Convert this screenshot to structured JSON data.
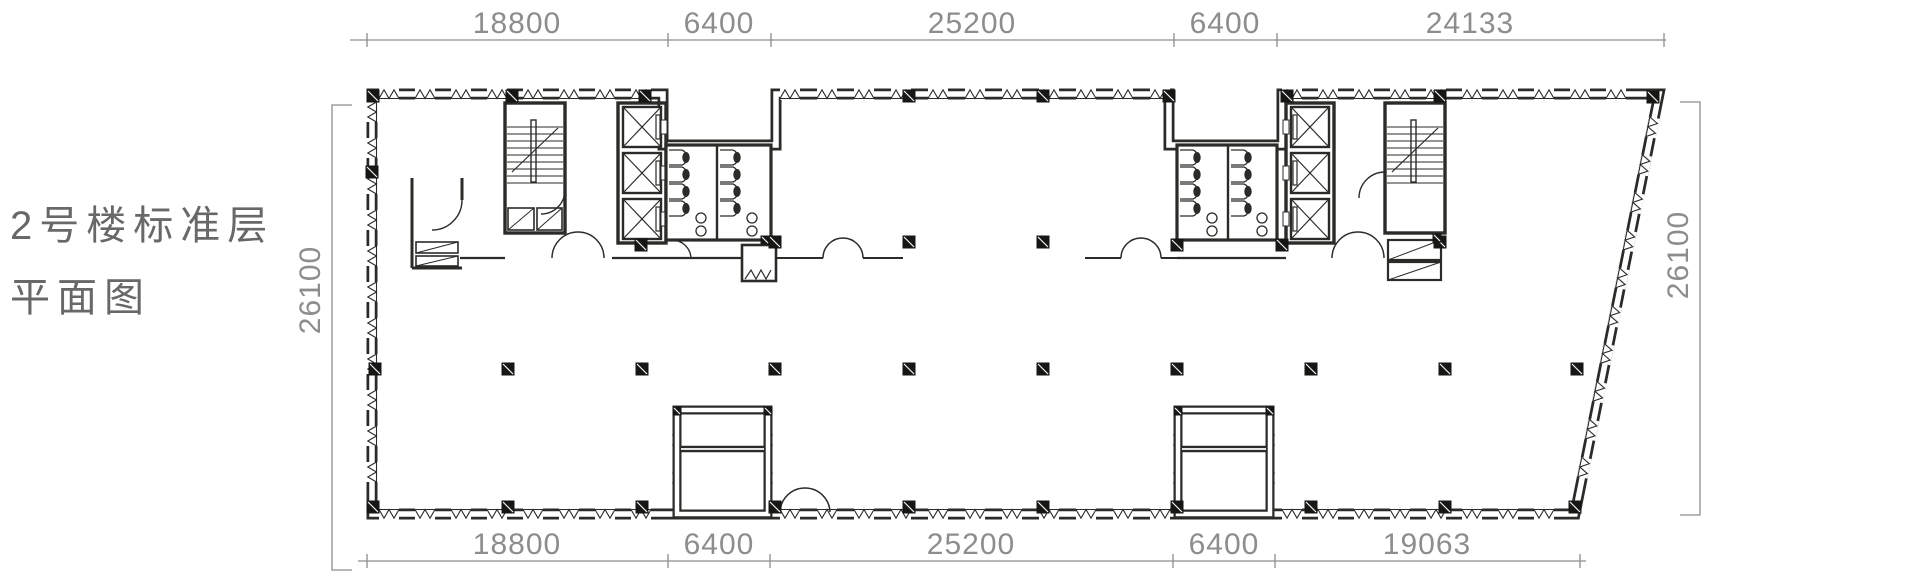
{
  "title": {
    "line1": "2号楼标准层",
    "line2": "平面图"
  },
  "dimensions": {
    "top": [
      {
        "label": "18800"
      },
      {
        "label": "6400"
      },
      {
        "label": "25200"
      },
      {
        "label": "6400"
      },
      {
        "label": "24133"
      }
    ],
    "bottom": [
      {
        "label": "18800"
      },
      {
        "label": "6400"
      },
      {
        "label": "25200"
      },
      {
        "label": "6400"
      },
      {
        "label": "19063"
      }
    ],
    "left": {
      "label": "26100"
    },
    "right": {
      "label": "26100"
    }
  },
  "drawing": {
    "type": "architectural-floor-plan",
    "features": [
      "perimeter-curtain-wall-windows",
      "two-service-cores",
      "staircases",
      "elevator-shafts",
      "toilet-blocks",
      "structural-columns",
      "bottom-shafts",
      "slanted-east-wall"
    ]
  },
  "colors": {
    "plan_line": "#2b2b28",
    "column_fill": "#161614",
    "dimension_line": "#8d8d8d",
    "title_text": "#686868",
    "background": "#ffffff"
  }
}
